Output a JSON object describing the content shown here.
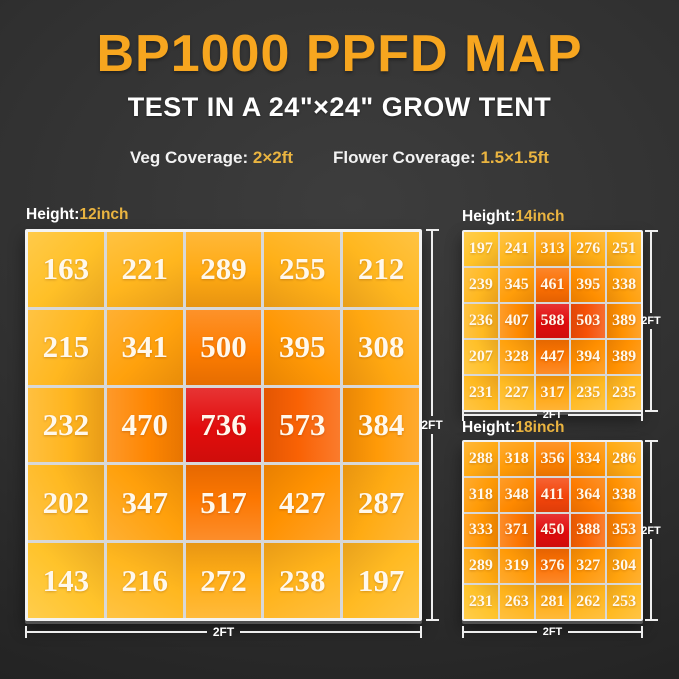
{
  "header": {
    "title": "BP1000 PPFD MAP",
    "subtitle": "TEST IN A 24\"×24\" GROW TENT",
    "veg_label": "Veg Coverage:",
    "veg_value": "2×2ft",
    "flower_label": "Flower Coverage:",
    "flower_value": "1.5×1.5ft"
  },
  "colors": {
    "accent_gold": "#f7a61f",
    "value_gold": "#eab440",
    "text_white": "#ffffff",
    "scale_low": "#ffc32a",
    "scale_mid": "#ff9000",
    "scale_high": "#e20d0d",
    "grid_line": "#f3f3f3",
    "background": "#303030"
  },
  "chart_data": [
    {
      "type": "heatmap",
      "title": "Height:12inch",
      "height_label": "Height:",
      "height_value": "12inch",
      "rows": 5,
      "cols": 5,
      "values": [
        [
          163,
          221,
          289,
          255,
          212
        ],
        [
          215,
          341,
          500,
          395,
          308
        ],
        [
          232,
          470,
          736,
          573,
          384
        ],
        [
          202,
          347,
          517,
          427,
          287
        ],
        [
          143,
          216,
          272,
          238,
          197
        ]
      ],
      "x_dim_label": "2FT",
      "y_dim_label": "2FT",
      "legend": "values are PPFD readings; color normalized gold(min) to red(max)"
    },
    {
      "type": "heatmap",
      "title": "Height:14inch",
      "height_label": "Height:",
      "height_value": "14inch",
      "rows": 5,
      "cols": 5,
      "values": [
        [
          197,
          241,
          313,
          276,
          251
        ],
        [
          239,
          345,
          461,
          395,
          338
        ],
        [
          236,
          407,
          588,
          503,
          389
        ],
        [
          207,
          328,
          447,
          394,
          389
        ],
        [
          231,
          227,
          317,
          235,
          235
        ]
      ],
      "x_dim_label": "2FT",
      "y_dim_label": "2FT",
      "legend": "values are PPFD readings; color normalized gold(min) to red(max)"
    },
    {
      "type": "heatmap",
      "title": "Height:18inch",
      "height_label": "Height:",
      "height_value": "18inch",
      "rows": 5,
      "cols": 5,
      "values": [
        [
          288,
          318,
          356,
          334,
          286
        ],
        [
          318,
          348,
          411,
          364,
          338
        ],
        [
          333,
          371,
          450,
          388,
          353
        ],
        [
          289,
          319,
          376,
          327,
          304
        ],
        [
          231,
          263,
          281,
          262,
          253
        ]
      ],
      "x_dim_label": "2FT",
      "y_dim_label": "2FT",
      "legend": "values are PPFD readings; color normalized gold(min) to red(max)"
    }
  ]
}
